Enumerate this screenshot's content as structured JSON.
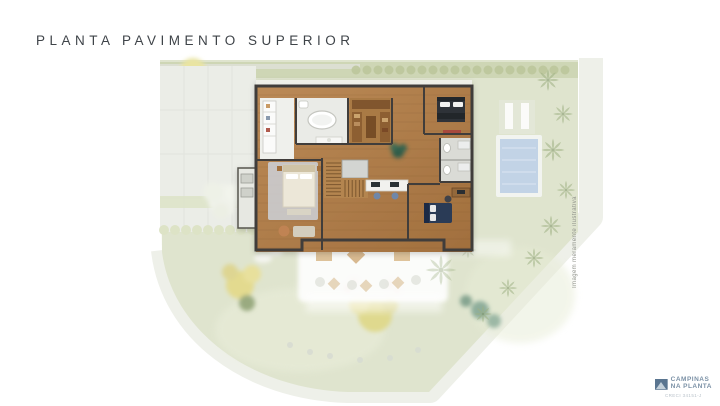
{
  "title": "PLANTA PAVIMENTO SUPERIOR",
  "caption": "Imagem meramente ilustrativa",
  "logo": {
    "line1": "CAMPINAS",
    "line2": "NA PLANTA",
    "registration": "CRECI 34151-J"
  },
  "colors": {
    "background": "#ffffff",
    "title-ink": "#3f4449",
    "lot-green": "#dfe4ce",
    "hedge-green": "#cbd3b0",
    "street-gray": "#eef0e9",
    "paving": "#ebede7",
    "wood-floor": "#b1804e",
    "wall-ink": "#3f3e3a",
    "pool-water": "#c2d3e6",
    "terrace-white": "#fdfdfc",
    "logo-blue": "#7b91a6",
    "caption-ink": "#8f928a"
  }
}
